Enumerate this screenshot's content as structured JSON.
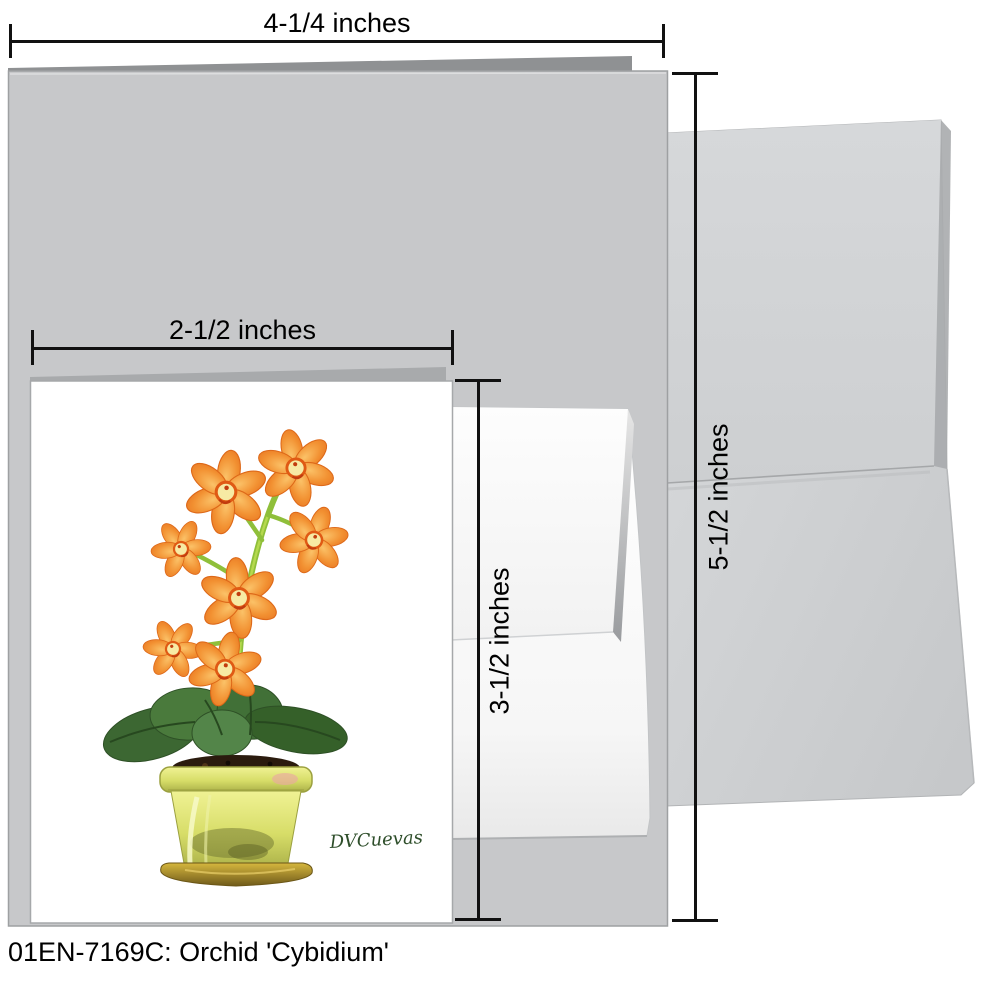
{
  "caption": "01EN-7169C: Orchid 'Cybidium'",
  "artwork": {
    "signature": "DVCuevas"
  },
  "dimensions": {
    "large_card_width": "4-1/4 inches",
    "large_card_height": "5-1/2 inches",
    "small_card_width": "2-1/2 inches",
    "small_card_height": "3-1/2 inches"
  },
  "colors": {
    "large_card_gray": "#c7c8ca",
    "card_back_edge_gray": "#8f9193",
    "envelope_gray": "#d2d4d6",
    "small_envelope_white": "#fcfcfc",
    "small_card_white": "#ffffff",
    "flower_orange": "#f08a2c",
    "flower_center_yellow": "#f7eaa4",
    "stem_green": "#8fbf3a",
    "leaf_green": "#3f6b35",
    "pot_yellow_green": "#dde077",
    "saucer_gold": "#c9a52e",
    "soil_brown": "#2b1b0e",
    "signature_green": "#2e4e2a",
    "dimension_line_black": "#111111"
  }
}
